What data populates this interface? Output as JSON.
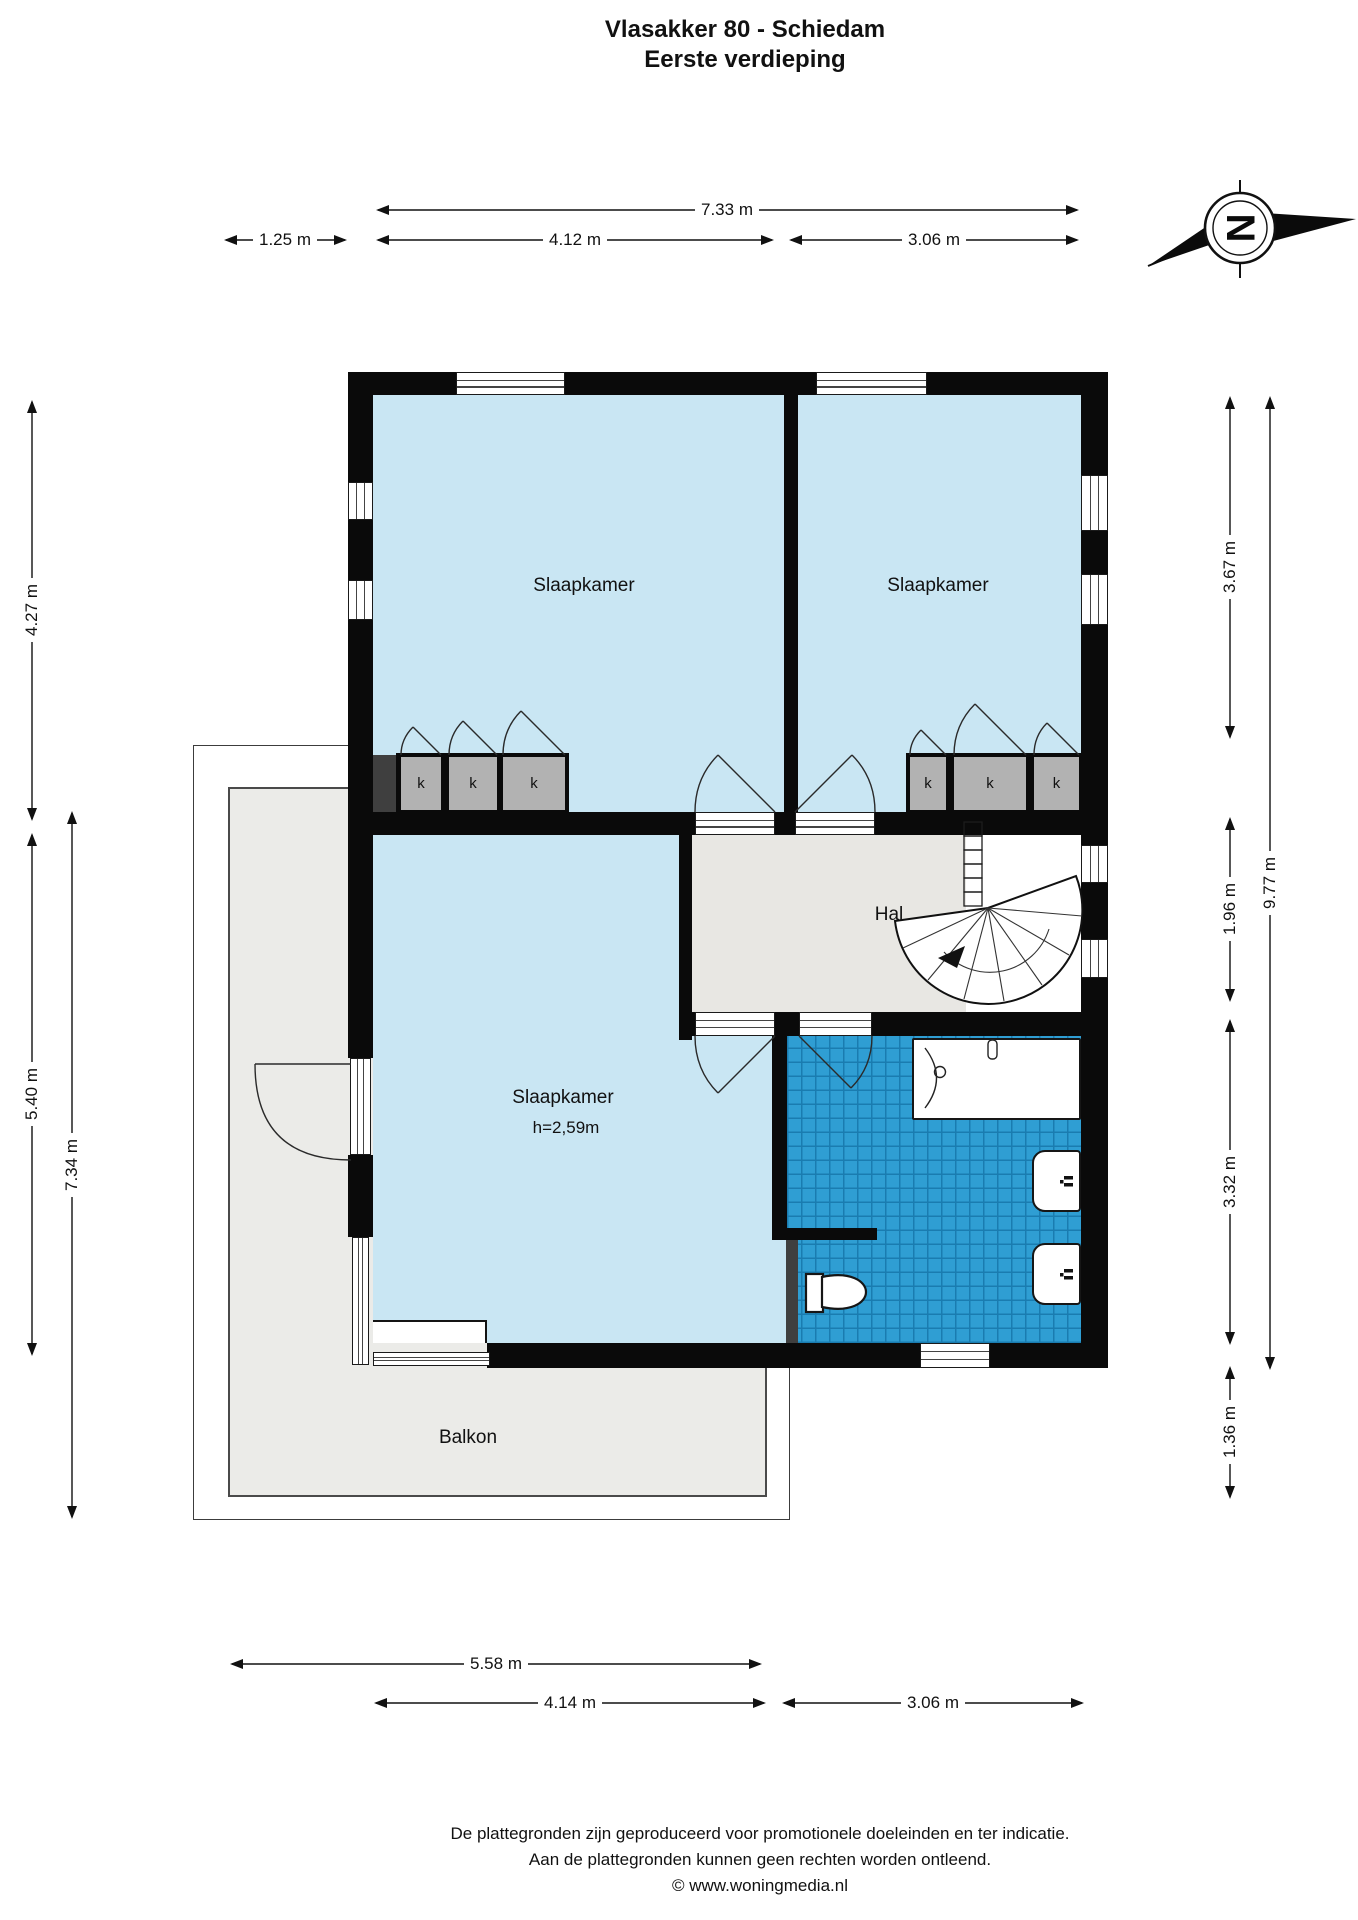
{
  "header": {
    "title": "Vlasakker 80 - Schiedam",
    "subtitle": "Eerste verdieping"
  },
  "compass": {
    "letter": "N"
  },
  "rooms": {
    "bedroom_top_left": {
      "label": "Slaapkamer"
    },
    "bedroom_top_right": {
      "label": "Slaapkamer"
    },
    "bedroom_bottom": {
      "label": "Slaapkamer",
      "height_note": "h=2,59m"
    },
    "hall": {
      "label": "Hal"
    },
    "balcony": {
      "label": "Balkon"
    }
  },
  "closets": {
    "label": "k"
  },
  "dimensions": {
    "top": [
      {
        "label": "7.33 m"
      },
      {
        "label": "1.25 m"
      },
      {
        "label": "4.12 m"
      },
      {
        "label": "3.06 m"
      }
    ],
    "bottom": [
      {
        "label": "5.58 m"
      },
      {
        "label": "4.14 m"
      },
      {
        "label": "3.06 m"
      }
    ],
    "left": [
      {
        "label": "4.27 m"
      },
      {
        "label": "5.40 m"
      },
      {
        "label": "7.34 m"
      }
    ],
    "right": [
      {
        "label": "3.67 m"
      },
      {
        "label": "1.96 m"
      },
      {
        "label": "3.32 m"
      },
      {
        "label": "1.36 m"
      },
      {
        "label": "9.77 m"
      }
    ]
  },
  "footer": {
    "line1": "De plattegronden zijn geproduceerd voor promotionele doeleinden en ter indicatie.",
    "line2": "Aan de plattegronden kunnen geen rechten worden ontleend.",
    "line3": "© www.woningmedia.nl"
  },
  "colors": {
    "bedroom": "#c9e6f3",
    "hall": "#e8e7e3",
    "tile": "#2f9ed3",
    "tile_line": "#1a7cb0",
    "balcony": "#ebebe8",
    "closet": "#b2b2b2",
    "wall": "#0a0a0a",
    "dark_wall": "#3f3f3f"
  }
}
